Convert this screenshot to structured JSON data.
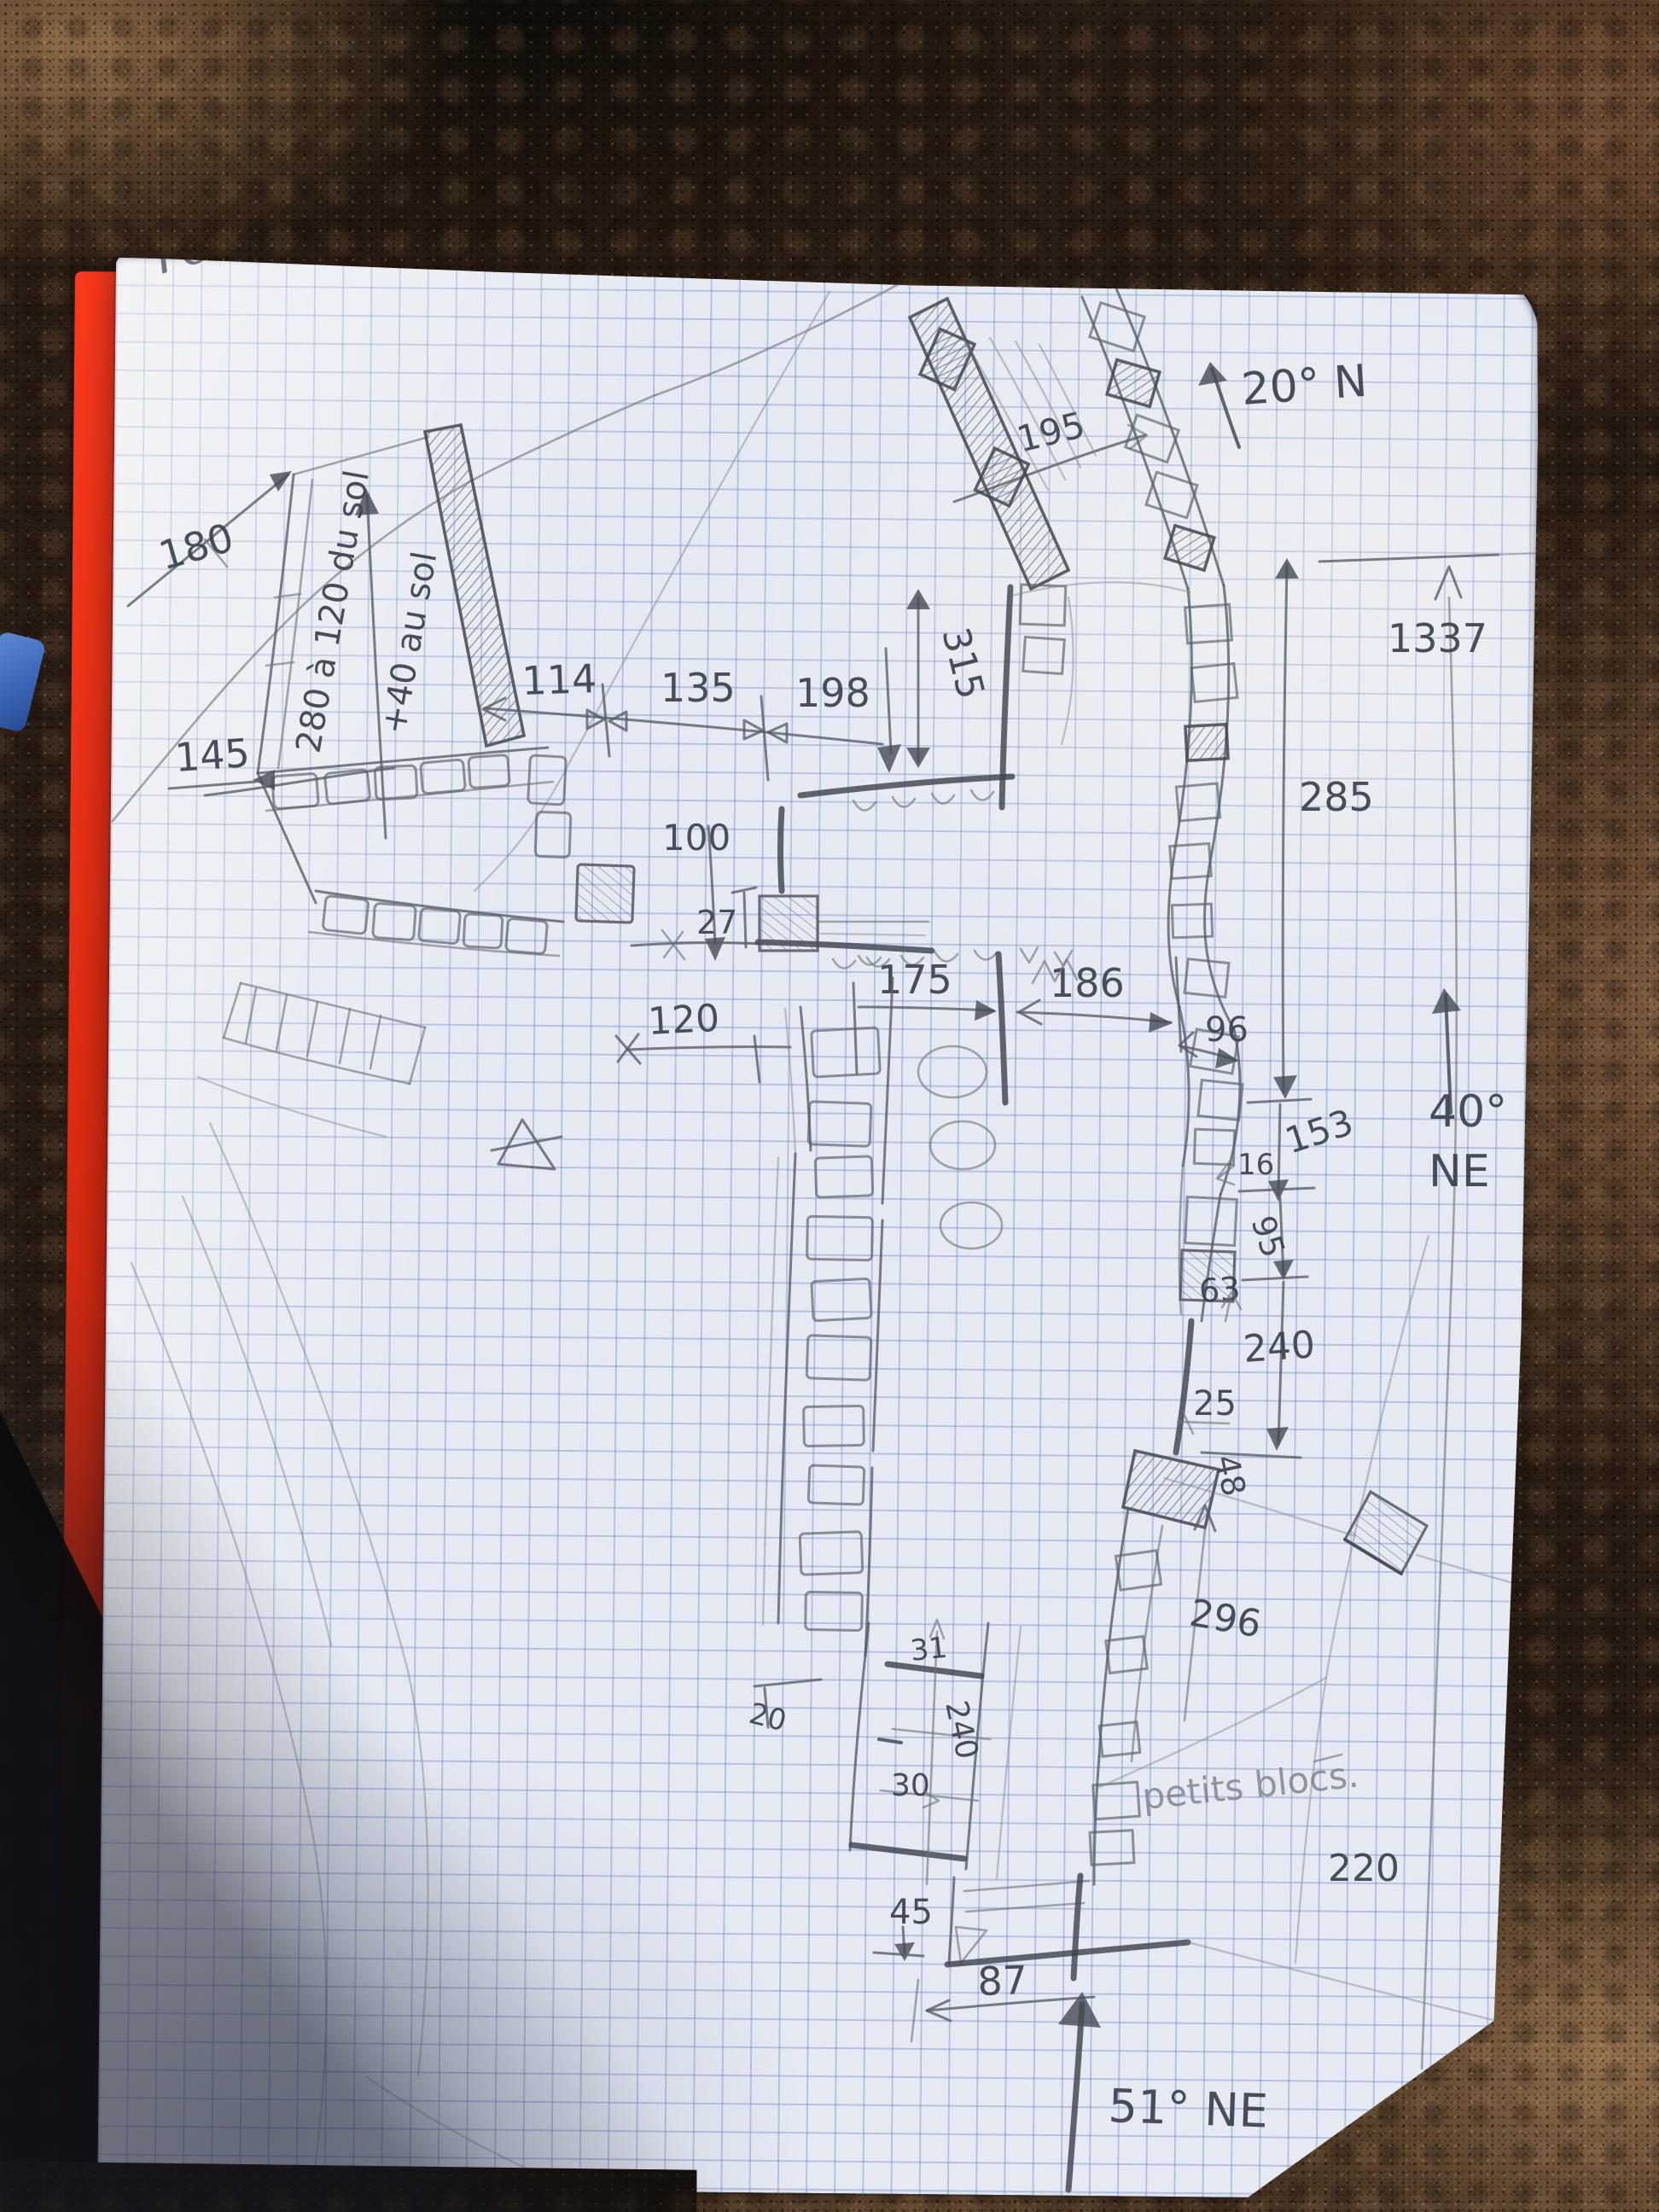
{
  "photo": {
    "colors": {
      "rock_dark": "#17100b",
      "rock_brown": "#6e4c33",
      "rock_tan": "#93704c",
      "cover_red": "#e02c12",
      "paper": "#e4e9f2",
      "grid_blue": "#6880c0",
      "pencil_dark": "#454b55",
      "pencil_light": "#7d848d",
      "blue_object": "#3c67b8"
    }
  },
  "sketch": {
    "site_label": "rocher",
    "area_label": "petits blocs.",
    "bearings": {
      "north": "20° N",
      "ne40_deg": "40°",
      "ne40_dir": "NE",
      "ne51": "51° NE"
    },
    "measurements": {
      "d180": "180",
      "d280": "280 à 120 du sol",
      "d40sol": "+40 au sol",
      "d145": "145",
      "d114": "114",
      "d135": "135",
      "d198": "198",
      "d195": "195",
      "d315": "315",
      "d100": "100",
      "d27": "27",
      "d175": "175",
      "d186": "186",
      "d96": "96",
      "d120": "120",
      "d1337": "1337",
      "d285": "285",
      "d153": "153",
      "d16": "16",
      "d95": "95",
      "d63": "63",
      "d240": "240",
      "d25": "25",
      "d48": "48",
      "d296": "296",
      "d220": "220",
      "d31": "31",
      "d240b": "240",
      "d30": "30",
      "d20": "20",
      "d45": "45",
      "d87": "87"
    }
  }
}
